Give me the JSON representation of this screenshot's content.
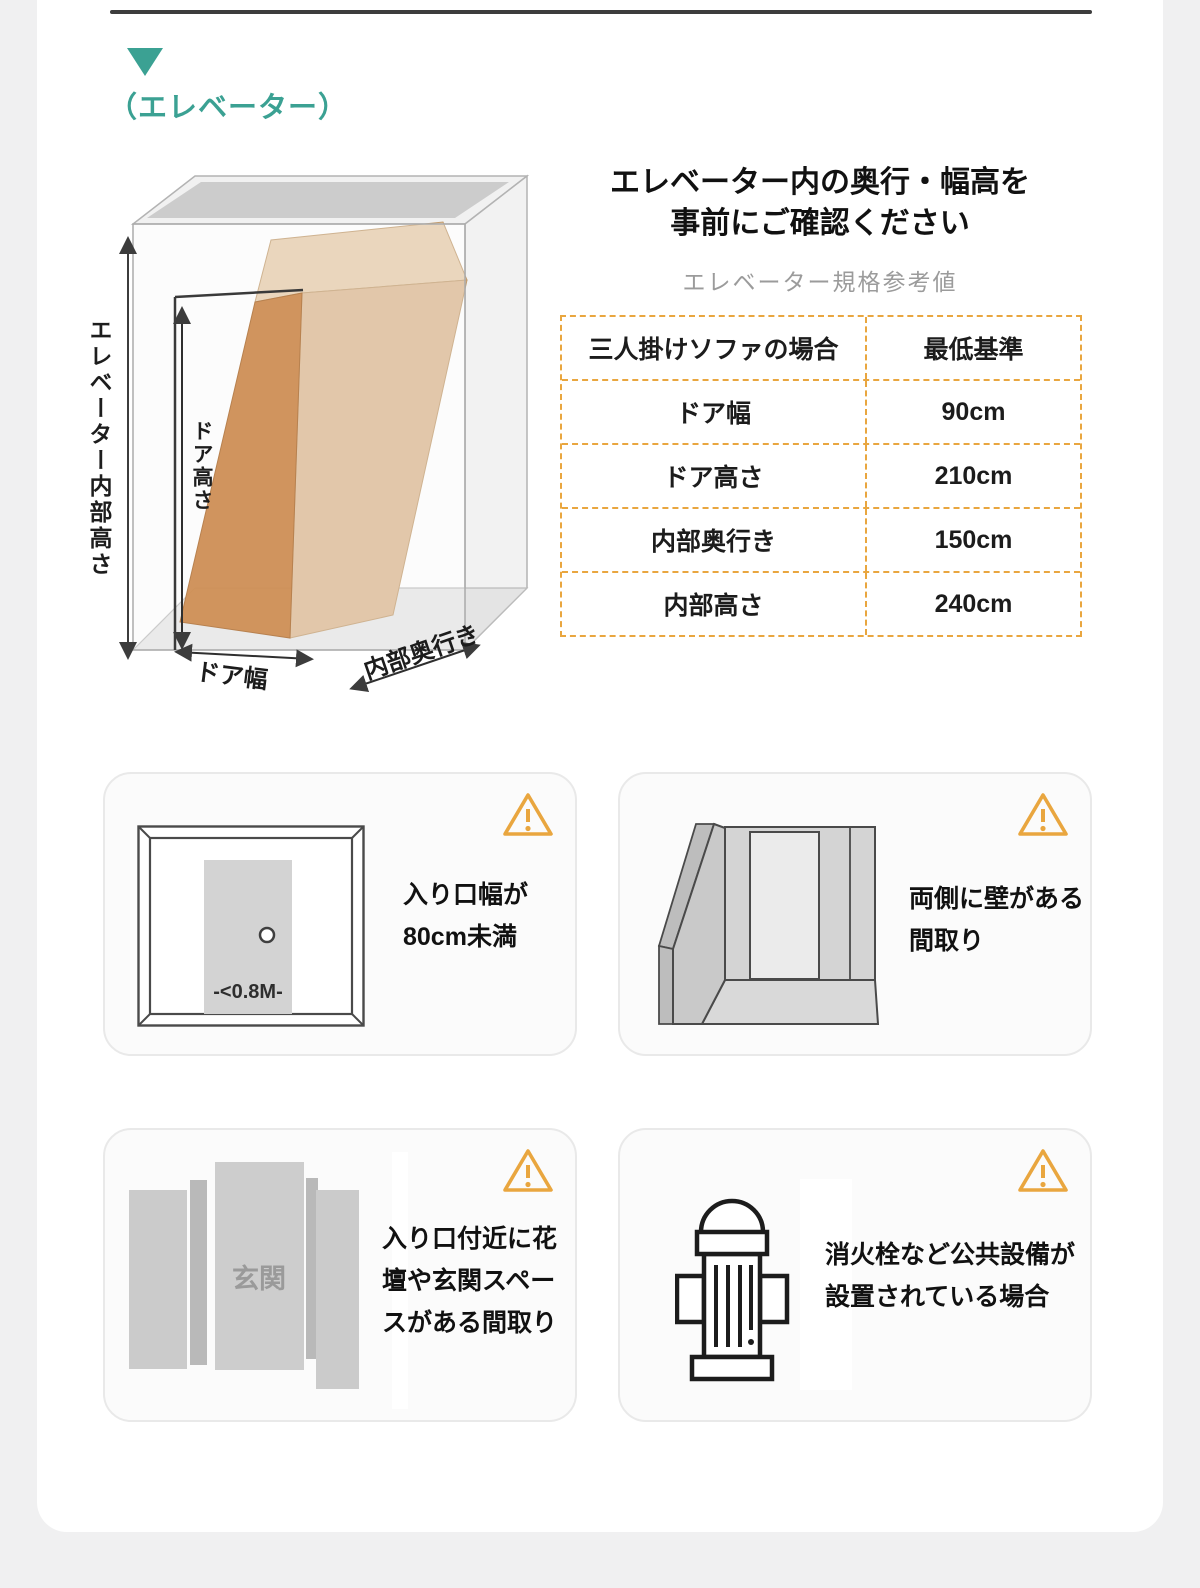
{
  "colors": {
    "accent_teal": "#3BA193",
    "warning_orange": "#E9A63F",
    "page_background": "#F0F0F1",
    "panel_background": "#FFFFFF",
    "card_background": "#FBFBFB",
    "subtitle_gray": "#9B9B9B",
    "sofa_box_orange": "#C06818",
    "sofa_box_tan": "#DCB68E"
  },
  "header": {
    "marker_icon": "down-triangle-icon",
    "title": "（エレベーター）"
  },
  "elevator_diagram": {
    "inner_height_label": "エレベーター内部高さ",
    "door_height_label": "ドア高さ",
    "door_width_label": "ドア幅",
    "inner_depth_label": "内部奥行き"
  },
  "notice": {
    "title_line1": "エレベーター内の奥行・幅高を",
    "title_line2": "事前にご確認ください",
    "subtitle": "エレベーター規格参考値"
  },
  "spec_table": {
    "headers": [
      "三人掛けソファの場合",
      "最低基準"
    ],
    "rows": [
      {
        "label": "ドア幅",
        "value": "90cm"
      },
      {
        "label": "ドア高さ",
        "value": "210cm"
      },
      {
        "label": "内部奥行き",
        "value": "150cm"
      },
      {
        "label": "内部高さ",
        "value": "240cm"
      }
    ]
  },
  "warning_cards": [
    {
      "lines": [
        "入り口幅が",
        "80cm未満"
      ],
      "diagram_text": "-<0.8M-"
    },
    {
      "lines": [
        "両側に壁がある",
        "間取り"
      ]
    },
    {
      "lines": [
        "入り口付近に花",
        "壇や玄関スペー",
        "スがある間取り"
      ],
      "diagram_text": "玄関"
    },
    {
      "lines": [
        "消火栓など公共設備が",
        "設置されている場合"
      ]
    }
  ]
}
